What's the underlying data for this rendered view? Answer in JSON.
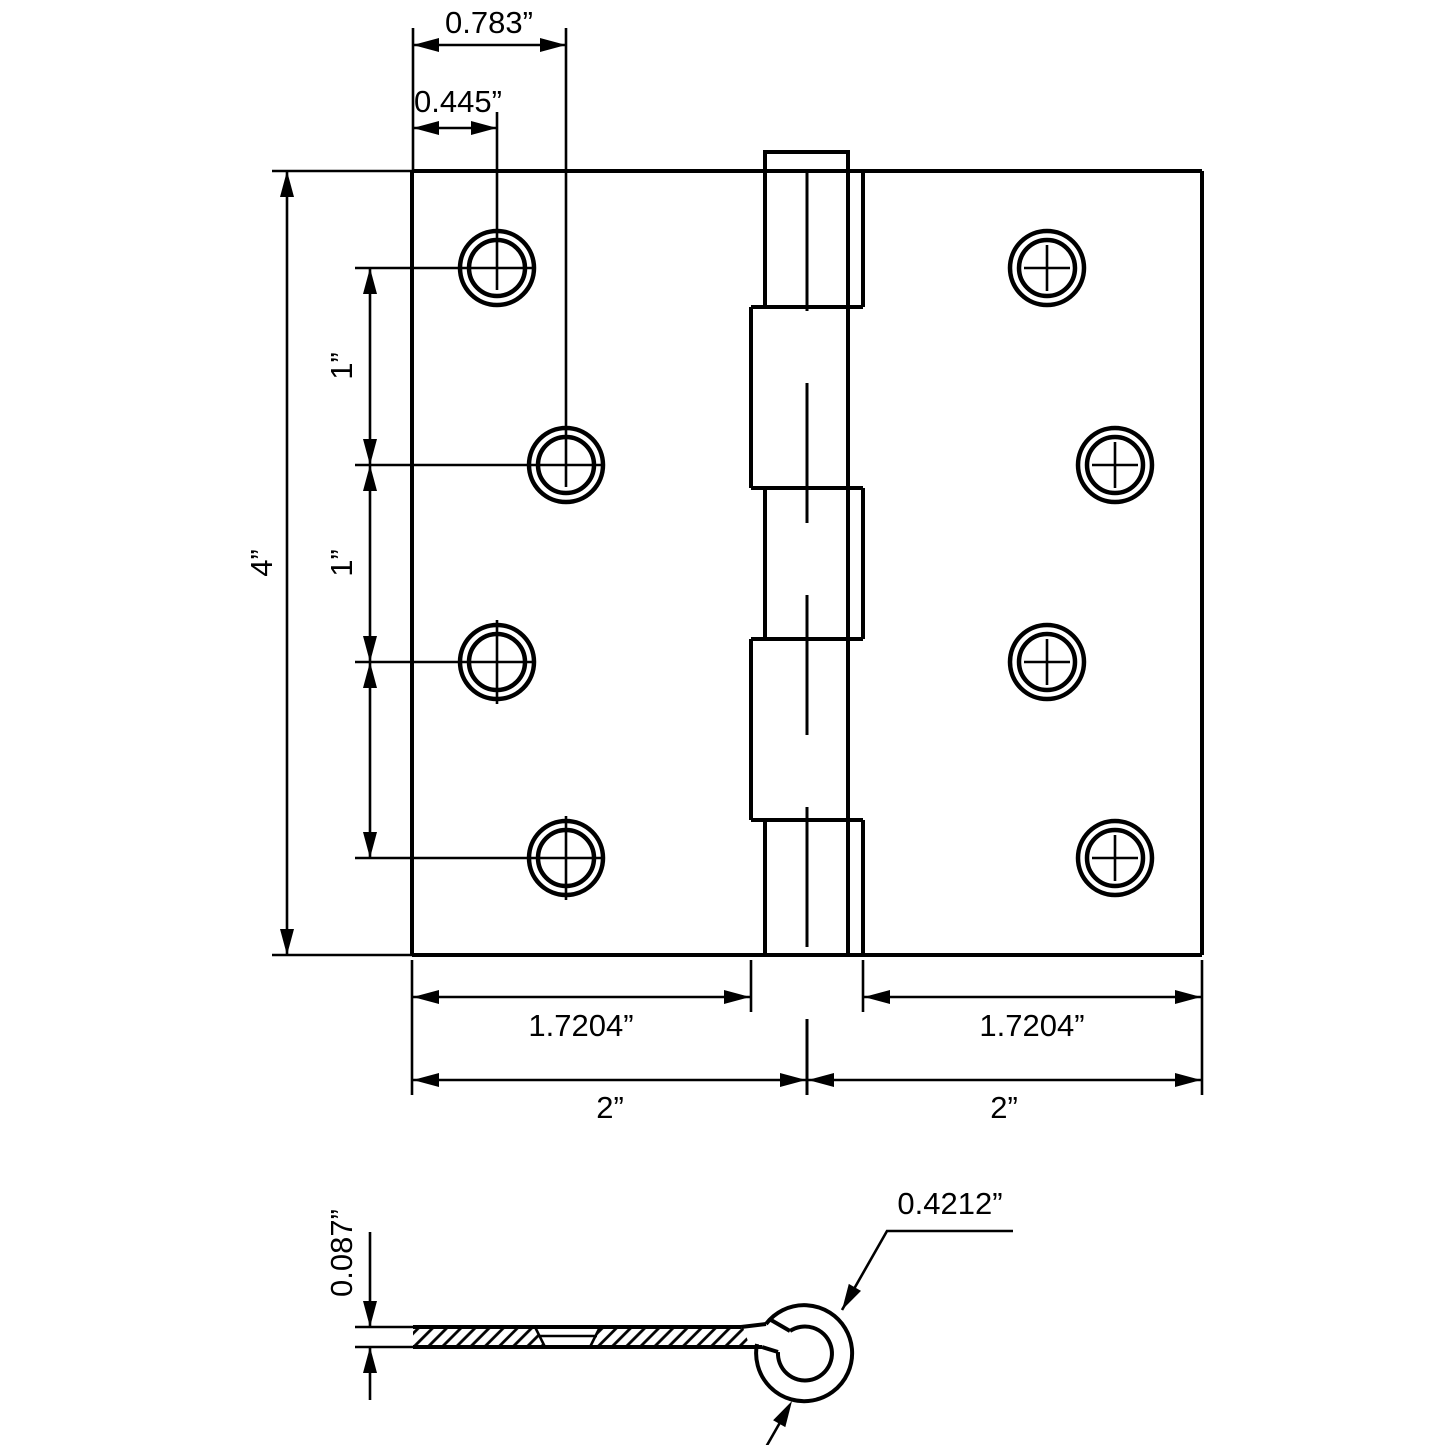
{
  "drawing": {
    "subject": "door hinge technical dimension drawing",
    "views": {
      "front": "hinge front elevation",
      "side": "leaf cross-section with knuckle curl"
    },
    "front_view": {
      "screw_holes": 8,
      "knuckles": 5
    },
    "colors": {
      "line": "#000000",
      "background": "#ffffff"
    }
  },
  "labels": {
    "top_offset": "0.783”",
    "inner_offset": "0.445”",
    "height": "4”",
    "spacing1": "1”",
    "spacing2": "1”",
    "spacing3": "1”",
    "leaf_left": "1.7204”",
    "leaf_right": "1.7204”",
    "half_left": "2”",
    "half_right": "2”",
    "thickness": "0.087”",
    "knuckle_diameter": "0.4212”"
  }
}
